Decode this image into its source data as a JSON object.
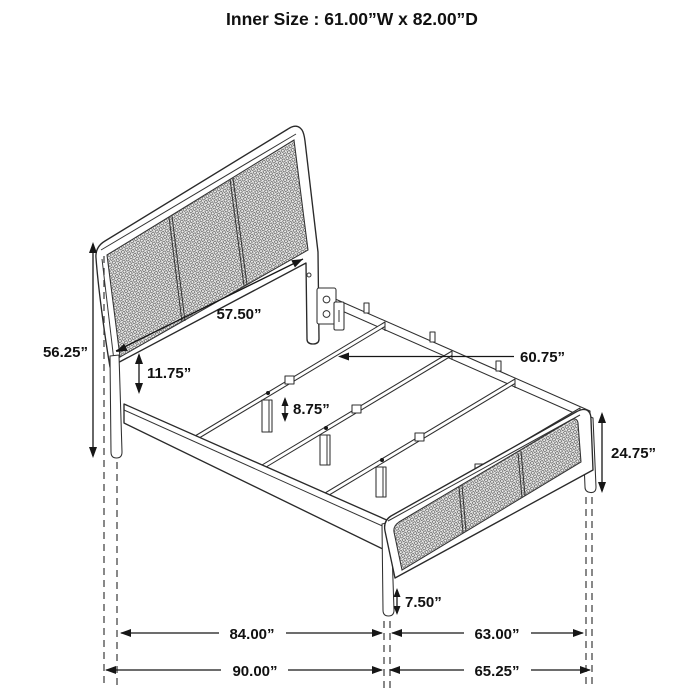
{
  "title": "Inner Size : 61.00”W x 82.00”D",
  "colors": {
    "line": "#2a2a2a",
    "text": "#111111",
    "background": "#ffffff"
  },
  "dims": {
    "headboard_width": "57.50”",
    "overall_height": "56.25”",
    "headboard_panel_gap": "11.75”",
    "slat_leg_height": "8.75”",
    "slat_length": "60.75”",
    "footboard_height": "24.75”",
    "footboard_leg_height": "7.50”",
    "inner_length": "84.00”",
    "footboard_inner_width": "63.00”",
    "overall_length": "90.00”",
    "footboard_overall_width": "65.25”"
  }
}
